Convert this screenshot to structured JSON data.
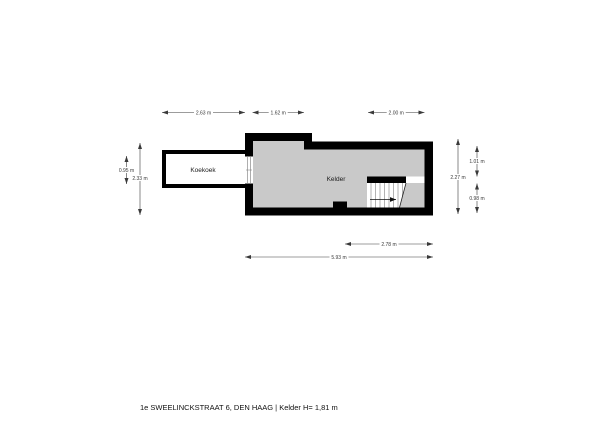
{
  "floorplan": {
    "rooms": [
      {
        "label": "Koekoek"
      },
      {
        "label": "Kelder"
      }
    ],
    "dimensions": [
      {
        "side": "top",
        "label": "2.63 m"
      },
      {
        "side": "top",
        "label": "1.62 m"
      },
      {
        "side": "top",
        "label": "2.00 m"
      },
      {
        "side": "left",
        "label": "0.95 m"
      },
      {
        "side": "left",
        "label": "2.33 m"
      },
      {
        "side": "right",
        "label": "2.27 m"
      },
      {
        "side": "right",
        "label": "1.01 m"
      },
      {
        "side": "right",
        "label": "0.98 m"
      },
      {
        "side": "bottom",
        "label": "2.78 m"
      },
      {
        "side": "bottom",
        "label": "5.93 m"
      }
    ],
    "stairs": {
      "arrow_direction": "right"
    },
    "caption": "1e SWEELINCKSTRAAT 6, DEN HAAG | Kelder H= 1,81 m",
    "colors": {
      "wall": "#000000",
      "floor": "#c9c9c9",
      "background": "#ffffff",
      "dimension": "#3a3a3a"
    }
  }
}
